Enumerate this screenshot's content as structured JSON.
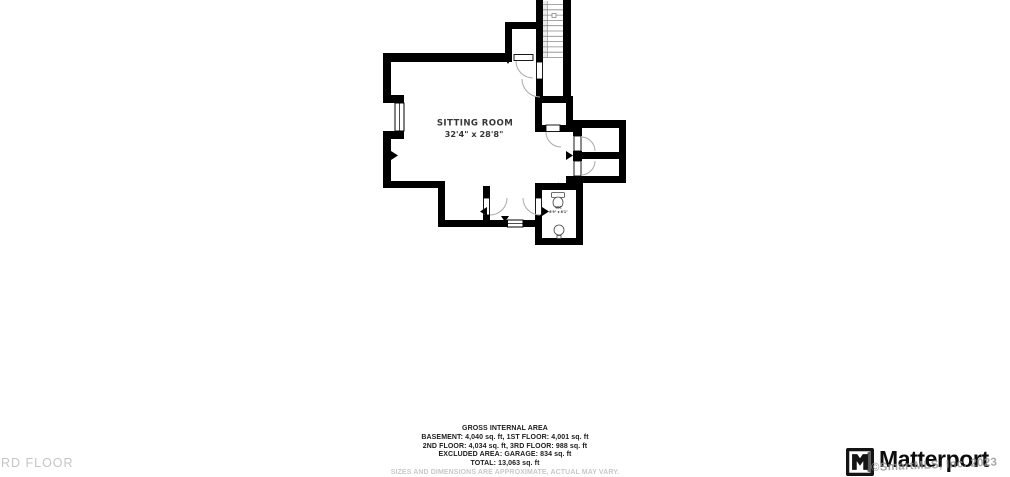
{
  "floor_label": "3RD FLOOR",
  "plan": {
    "room_label": "SITTING ROOM",
    "room_dims": "32'4\" x 28'8\"",
    "wc_label": "WC",
    "wc_dims": "6'9\" x 8'1\""
  },
  "summary": {
    "title": "GROSS INTERNAL AREA",
    "lines": [
      "BASEMENT: 4,040 sq. ft, 1ST FLOOR: 4,001 sq. ft",
      "2ND FLOOR: 4,034 sq. ft, 3RD FLOOR: 988 sq. ft",
      "EXCLUDED AREA: GARAGE: 834 sq. ft",
      "TOTAL: 13,063 sq. ft"
    ],
    "disclaimer": "SIZES AND DIMENSIONS ARE APPROXIMATE, ACTUAL MAY VARY."
  },
  "branding": {
    "logo_text": "Matterport",
    "watermark": "©SmartMLS, Inc. 2023"
  },
  "colors": {
    "wall": "#000000",
    "plan_label": "#383838",
    "muted_gray": "#c5c5c5",
    "watermark_gray": "#909090"
  }
}
